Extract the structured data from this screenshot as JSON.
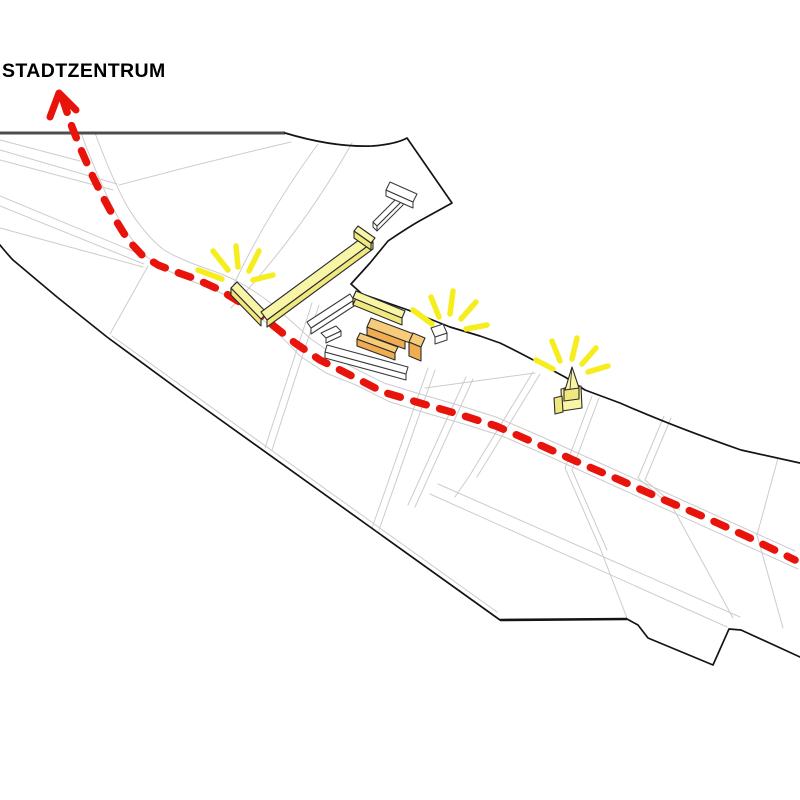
{
  "route": {
    "destination_label": "STADTZENTRUM",
    "style": "dashed",
    "direction": "arrow-up-left-exiting-map"
  },
  "map": {
    "highlighted_buildings_yellow": [
      "l-shaped-building",
      "bar-building",
      "church-tower"
    ],
    "highlighted_buildings_orange": [
      "central-hall"
    ],
    "context_buildings_white": [
      "t-shaped-building",
      "sliver-building-1",
      "sliver-building-2",
      "sliver-building-3",
      "sliver-building-4"
    ],
    "sunburst_count": 3
  },
  "colors": {
    "background": "#ffffff",
    "route": "#e8140c",
    "highlight_ray": "#f6ed1f",
    "building_yellow_top": "#f8f5a7",
    "building_yellow_side": "#f0e87e",
    "building_orange_top": "#f6cb7a",
    "building_orange_side": "#efac50",
    "building_white": "#ffffff",
    "building_outline": "#2b2b2b",
    "street": "#cccccc",
    "boundary": "#141414",
    "boundary_heavy": "#4d4d4d",
    "label_text": "#000000"
  }
}
